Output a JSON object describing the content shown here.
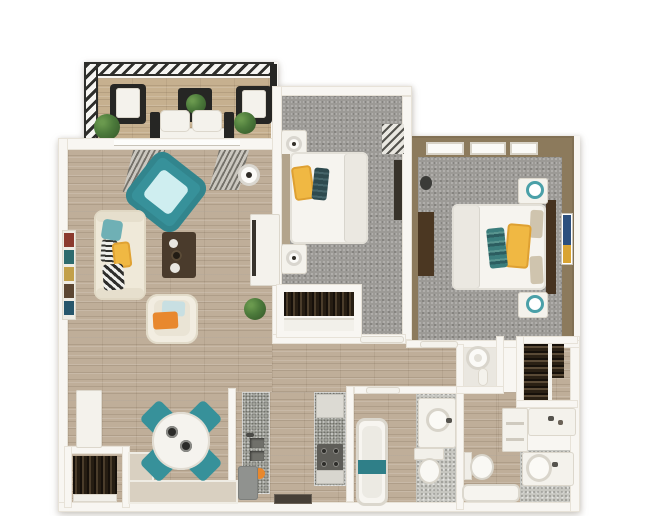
{
  "page": {
    "description": "3D top-down rendered floor plan of a two-bedroom, two-bath apartment with balcony",
    "visible_text": []
  },
  "colors": {
    "page-bg": "#ffffff",
    "wall": "#f8f6f2",
    "wall-edge": "#e7e2d8",
    "wall-tan": "#8c7a5c",
    "wall-beige": "#d9d0c1",
    "wood": "#bfae99",
    "wood-balcony": "#c6b08f",
    "carpet": "#9c9a96",
    "granite": "#adaea7",
    "teal": "#37919a",
    "teal-light": "#cfeef0",
    "teal-lamp": "#4aa0a8",
    "yellow": "#f0b843",
    "orange": "#e8882e",
    "cream": "#efe9d9",
    "white-furn": "#f4f2ec",
    "duvet": "#f6f4ef",
    "blanket": "#ebe8e1",
    "brown-table": "#4a3b2c",
    "brown-headboard": "#46321f",
    "black-furn": "#262624",
    "green": "#4c7a3b",
    "green-dark": "#3a5f2d",
    "gray-appliance": "#90928f",
    "towel-teal": "#2f7f88",
    "art-blue": "#2b4f7e",
    "art-gold": "#d9a433"
  },
  "rooms": [
    {
      "name": "balcony",
      "floor": "wood",
      "features": [
        "hatched-railing",
        "black-armchair-left",
        "black-armchair-right",
        "side-table-with-plant",
        "white-loveseat",
        "plant-left",
        "plant-right"
      ]
    },
    {
      "name": "living-room",
      "floor": "wood",
      "features": [
        "window-wall",
        "gray-curtains",
        "teal-accent-chair",
        "cream-sofa-with-pillows",
        "dark-coffee-table",
        "white-armchair-orange-pillow",
        "tv-console",
        "floor-lamp",
        "wall-shelf",
        "potted-plant"
      ]
    },
    {
      "name": "dining-area",
      "floor": "wood",
      "features": [
        "round-white-table",
        "four-teal-chairs"
      ]
    },
    {
      "name": "kitchen",
      "floor": "wood",
      "features": [
        "granite-counter-left-with-double-sink",
        "granite-counter-right-with-stove",
        "gray-appliance",
        "fruit",
        "floor-mat"
      ]
    },
    {
      "name": "bedroom-1",
      "floor": "carpet",
      "features": [
        "bed-white-duvet-yellow-teal-pillows",
        "nightstand-lamp-top",
        "nightstand-lamp-bottom",
        "corner-window-blinds",
        "wall-tv",
        "closet-with-hanging-clothes"
      ]
    },
    {
      "name": "bedroom-2",
      "floor": "carpet",
      "features": [
        "tan-walls",
        "three-windows",
        "bed-white-duvet-yellow-teal-pillows",
        "dark-headboard",
        "dresser",
        "nightstand-teal-lamp-top",
        "nightstand-teal-lamp-bottom",
        "wall-art-blue"
      ]
    },
    {
      "name": "hallway",
      "floor": "wood",
      "features": [
        "bedroom-doors"
      ]
    },
    {
      "name": "bathroom-1",
      "floor": "tile",
      "features": [
        "bathtub-with-teal-towel",
        "vanity-round-sink",
        "toilet"
      ]
    },
    {
      "name": "bathroom-2",
      "floor": "wood-and-tile",
      "features": [
        "l-shaped-vanity",
        "second-sink",
        "toilet",
        "bathtub"
      ]
    },
    {
      "name": "walk-in-closet",
      "floor": "wood",
      "features": [
        "two-rails-hanging-clothes"
      ]
    },
    {
      "name": "utility-closet",
      "features": [
        "water-heater"
      ]
    },
    {
      "name": "entry-closet",
      "features": [
        "hanging-coats",
        "shelf"
      ]
    },
    {
      "name": "entry",
      "features": [
        "door-panel"
      ]
    }
  ]
}
